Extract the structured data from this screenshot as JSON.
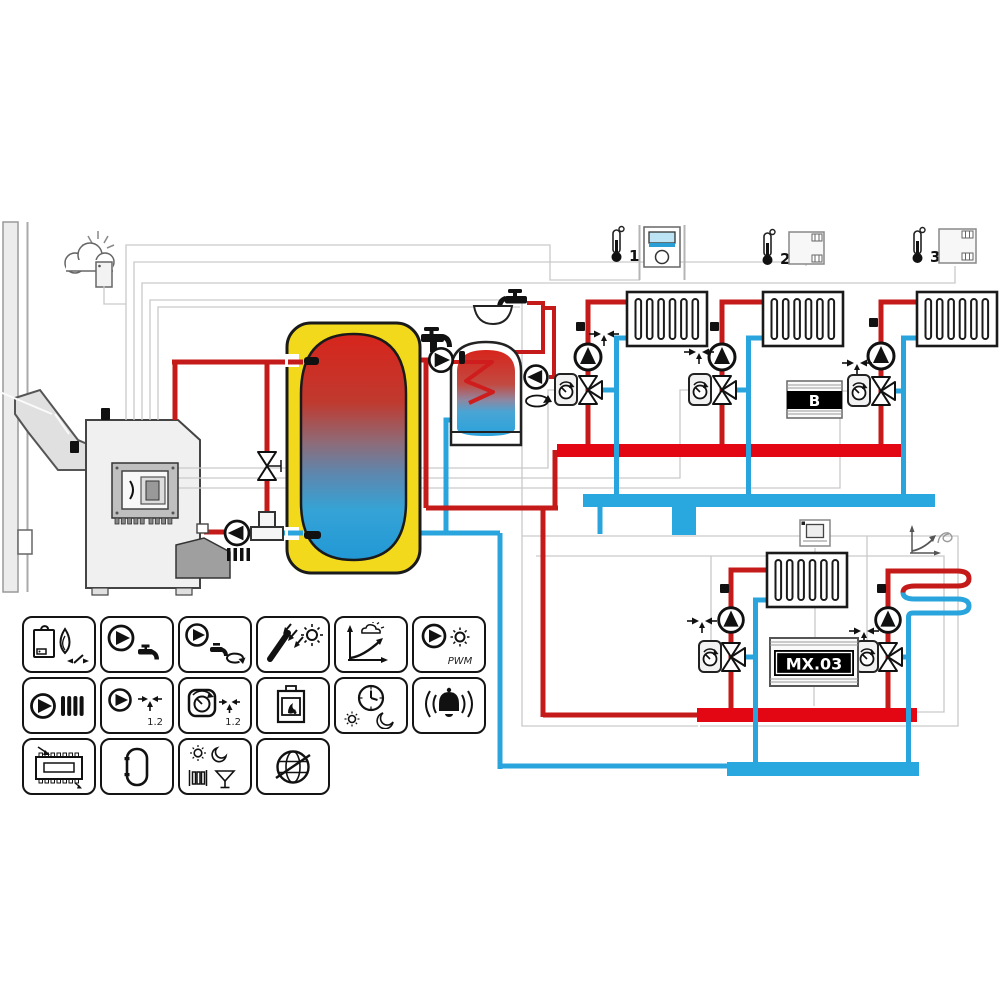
{
  "schematic": {
    "room_sensors": [
      {
        "label": "1"
      },
      {
        "label": "2"
      },
      {
        "label": "3"
      }
    ],
    "controller_b_label": "B",
    "controller_mx_label": "MX.03"
  },
  "icon_grid": {
    "rows": [
      {
        "icons": [
          "boiler-burner",
          "dhw-pump",
          "dhw-circulation-pump",
          "solar-collector",
          "heating-curve",
          "solar-pump-pwm"
        ]
      },
      {
        "icons": [
          "heating-pump",
          "mixer-pump-1-2",
          "mixer-valve-1-2",
          "fireplace",
          "timer-day-night",
          "alarm"
        ]
      },
      {
        "icons": [
          "controller-module",
          "buffer-tank",
          "party-holiday-mode",
          "internet-globe"
        ]
      }
    ],
    "pwm_label": "PWM",
    "mixer_pump_label": "1.2",
    "mixer_valve_label": "1.2"
  },
  "colors": {
    "pipe_supply": "#c41a1a",
    "pipe_return": "#2aa4dc",
    "manifold_supply": "#e30613",
    "manifold_return": "#29a8df",
    "buffer_jacket": "#f3d91c",
    "wire": "#c9c9c9"
  }
}
